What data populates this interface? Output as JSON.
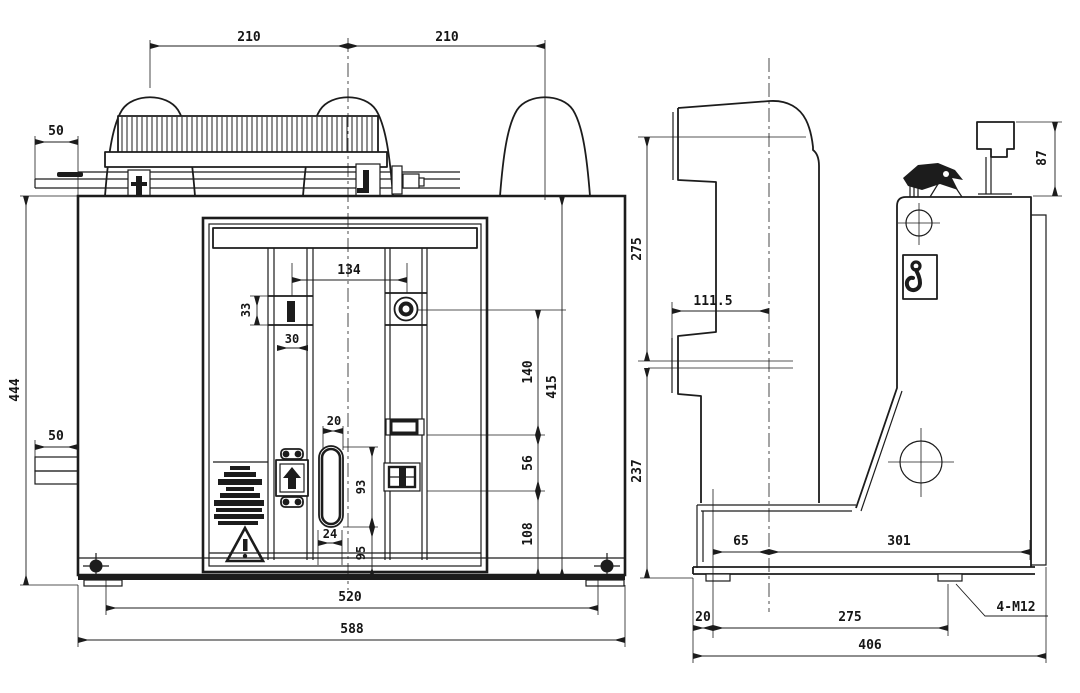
{
  "front_view": {
    "dimensions": {
      "top_span_left": "210",
      "top_span_right": "210",
      "arm_width_top": "50",
      "body_height": "444",
      "arm_width_bottom": "50",
      "panel_hole_spacing": "134",
      "slot_height_small": "33",
      "slot_width_small": "30",
      "keyhole_width_top": "20",
      "keyhole_height": "93",
      "keyhole_width_bottom": "24",
      "keyhole_to_base": "95",
      "right_upper": "140",
      "right_middle": "56",
      "right_lower": "108",
      "body_inner_height": "415",
      "foot_spacing": "520",
      "overall_width": "588"
    }
  },
  "side_view": {
    "dimensions": {
      "pole_height_upper": "275",
      "pole_height_lower": "237",
      "pole_depth": "111.5",
      "rail_height": "87",
      "base_front_offset": "65",
      "base_rear_span": "301",
      "foot_offset": "20",
      "foot_spacing": "275",
      "overall_depth": "406"
    },
    "callouts": {
      "mounting_holes": "4-M12"
    }
  },
  "icons": {
    "warning_triangle": "warning-triangle-icon",
    "lifting_hook": "lifting-hook-icon",
    "interlock_arrow": "up-arrow-icon",
    "datum_bolt": "crosshair-bolt-icon"
  },
  "colors": {
    "line": "#1c1c1c",
    "background": "#ffffff"
  }
}
